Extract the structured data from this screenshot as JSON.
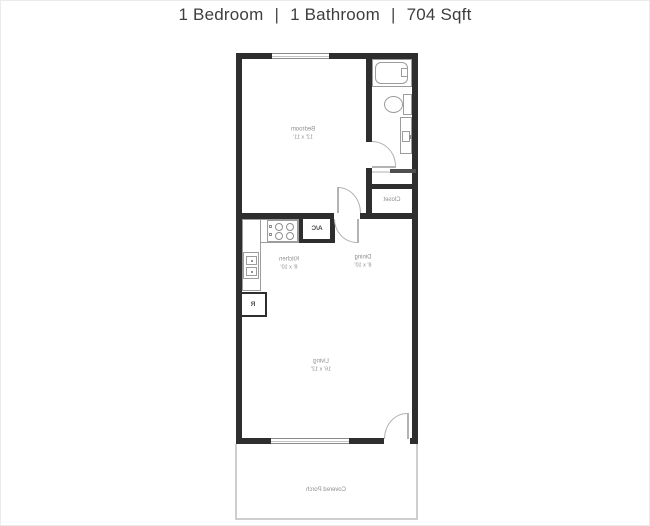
{
  "header": {
    "bedrooms": "1 Bedroom",
    "bathrooms": "1 Bathroom",
    "sqft": "704 Sqft",
    "separator": "|"
  },
  "floorplan": {
    "rooms": {
      "bedroom": {
        "name": "Bedroom",
        "dims": "12' x 11'"
      },
      "kitchen": {
        "name": "Kitchen",
        "dims": "8' x 10'"
      },
      "dining": {
        "name": "Dining",
        "dims": "8' x 10'"
      },
      "living": {
        "name": "Living",
        "dims": "16' x 12'"
      },
      "closet": {
        "name": "Closet"
      },
      "porch": {
        "name": "Covered Porch"
      }
    },
    "fixtures": {
      "ac_label": "A/C",
      "refrigerator_label": "R"
    },
    "colors": {
      "wall": "#2e2e2e",
      "fixture_outline": "#9c9c9c",
      "door_line": "#b3b3b3",
      "label_text": "#8e8e8e",
      "porch_outline": "#cecece",
      "title_text": "#3e3e3e"
    }
  }
}
